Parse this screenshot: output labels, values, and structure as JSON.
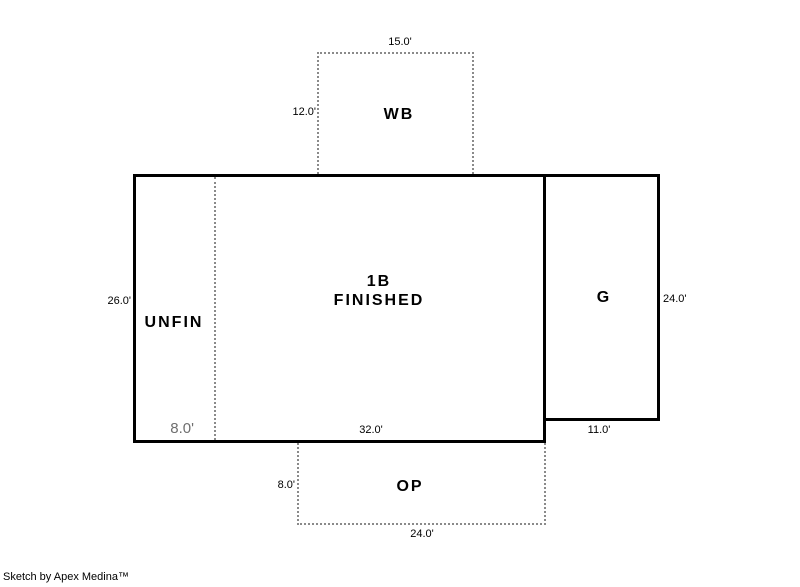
{
  "colors": {
    "background": "#ffffff",
    "solid_line": "#000000",
    "dashed_line": "#8a8a8a",
    "text": "#000000",
    "muted_dim_text": "#6f6f6f"
  },
  "sketch": {
    "wb": {
      "label": "WB",
      "top_dim": "15.0'",
      "left_dim": "12.0'"
    },
    "main": {
      "label_line1": "1B",
      "label_line2": "FINISHED",
      "left_dim": "26.0'",
      "bottom_dim": "32.0'"
    },
    "unfin": {
      "label": "UNFIN",
      "width_dim": "8.0'"
    },
    "garage": {
      "label": "G",
      "right_dim": "24.0'",
      "bottom_dim": "11.0'"
    },
    "op": {
      "label": "OP",
      "left_dim": "8.0'",
      "bottom_dim": "24.0'"
    }
  },
  "footer": {
    "credit": "Sketch by Apex Medina™"
  }
}
